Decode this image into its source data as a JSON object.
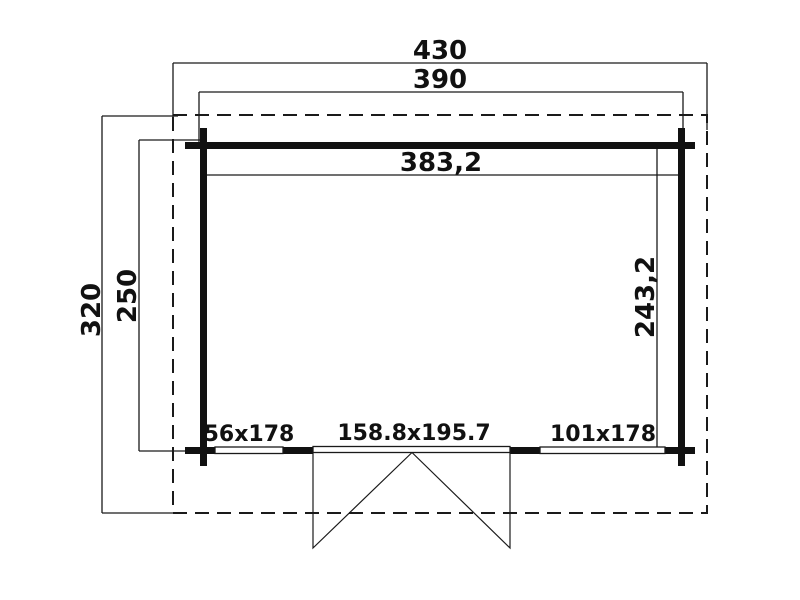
{
  "drawing": {
    "colors": {
      "line": "#1a1a1a",
      "background": "#ffffff"
    },
    "dimensions": {
      "overall_width": "430",
      "wall_outer_width": "390",
      "interior_width": "383,2",
      "overall_depth": "320",
      "wall_outer_depth": "250",
      "interior_depth": "243,2"
    },
    "openings": {
      "window_left": "56x178",
      "door": "158.8x195.7",
      "window_right": "101x178"
    }
  }
}
